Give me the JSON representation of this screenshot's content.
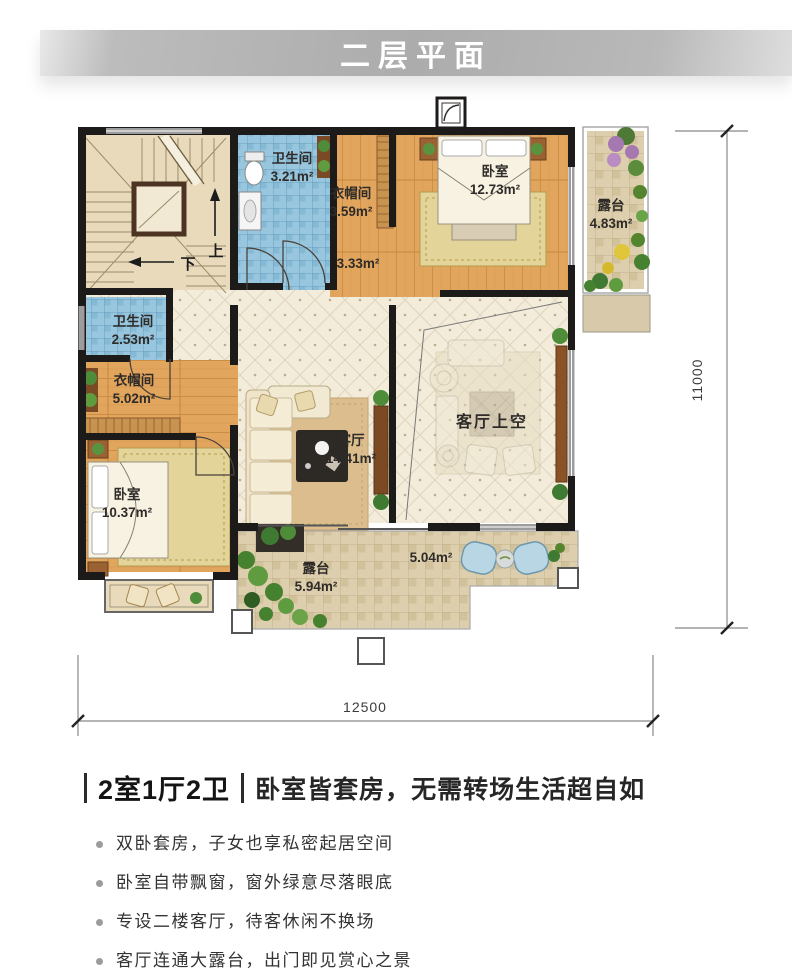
{
  "header": {
    "title": "二层平面"
  },
  "plan": {
    "rooms": [
      {
        "name": "卫生间",
        "area": "3.21m²"
      },
      {
        "name": "衣帽间",
        "area": "3.59m²"
      },
      {
        "name": "卧室",
        "area": "12.73m²"
      },
      {
        "name": "露台",
        "area": "4.83m²"
      },
      {
        "name": "",
        "area": "3.33m²"
      },
      {
        "name": "卫生间",
        "area": "2.53m²"
      },
      {
        "name": "衣帽间",
        "area": "5.02m²"
      },
      {
        "name": "卧室",
        "area": "10.37m²"
      },
      {
        "name": "客厅",
        "area": "14.41m²"
      },
      {
        "name": "客厅上空",
        "area": ""
      },
      {
        "name": "露台",
        "area": "5.94m²"
      },
      {
        "name": "",
        "area": "5.04m²"
      }
    ],
    "stairs": {
      "up": "上",
      "down": "下"
    },
    "dimensions": {
      "width": "12500",
      "height": "11000"
    },
    "palette": {
      "wall": "#1d1b19",
      "wood_floor": "#e2a55e",
      "bath_tile": "#98c6de",
      "terrace_tile": "#ddcfae",
      "banner_gray": "#b0b0b0"
    }
  },
  "summary": {
    "layout": "2室1厅2卫",
    "tagline": "卧室皆套房，无需转场生活超自如"
  },
  "features": [
    "双卧套房，子女也享私密起居空间",
    "卧室自带飘窗，窗外绿意尽落眼底",
    "专设二楼客厅，待客休闲不换场",
    "客厅连通大露台，出门即见赏心之景"
  ]
}
